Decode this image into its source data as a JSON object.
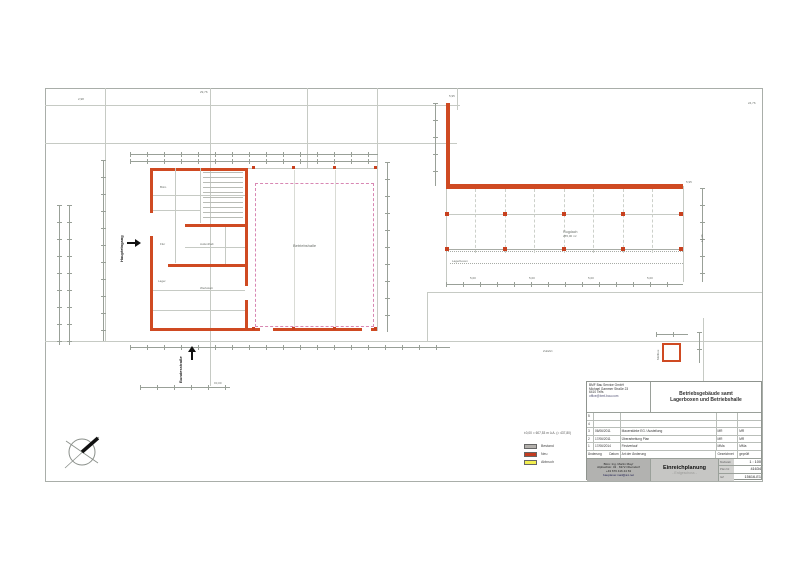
{
  "colors": {
    "wall_new": "#cf4a22",
    "column_red": "#c8401e",
    "roof_dashed": "#d887b3",
    "line_gray": "#b6bab4",
    "legend_bestand": "#b3b0ac",
    "legend_neu": "#c43c20",
    "legend_abbruch": "#f2ee50"
  },
  "plan_labels": {
    "bundesstrasse": "Bundesstraße",
    "haupteingang": "Haupteingang",
    "betriebshalle": "Betriebshalle",
    "flugdach": "Flugdach",
    "flugdach_area": "255,00 m²",
    "lagerboxen": "Lagerboxen",
    "zufahrt": "Zufahrt",
    "muellbox": "Müllbox",
    "room_buero": "Büro",
    "room_flur": "Flur",
    "room_lager": "Lager",
    "room_werkstatt": "Werkstatt",
    "room_aufenthalt": "Aufenthalt"
  },
  "dims": {
    "d_2976": "29,76",
    "d_595a": "5,95",
    "d_595b": "5,95",
    "d_2476": "24,76",
    "d_1246": "12,46",
    "d_500": "5,00",
    "d_298": "2,98",
    "d_pm": "±0,00"
  },
  "legend": {
    "level_note": "±0,00 = 607,53 m ü.A. (= 437,80)",
    "items": [
      {
        "label": "Bestand",
        "color": "#b3b0ac"
      },
      {
        "label": "Neu",
        "color": "#c43c20"
      },
      {
        "label": "Abbruch",
        "color": "#f2ee50"
      }
    ]
  },
  "titleblock": {
    "company_lines": [
      "BMF Bau Service GmbH",
      "Michael Gammer Straße 23",
      "6410 Telfs",
      "office@bmf-bau.com"
    ],
    "project_title_line1": "Betriebsgebäude samt",
    "project_title_line2": "Lagerboxen und Betriebshalle",
    "revisions": {
      "rows": [
        {
          "nr": "5",
          "datum": "",
          "text": "",
          "gez": "",
          "gepr": ""
        },
        {
          "nr": "4",
          "datum": "",
          "text": "",
          "gez": "",
          "gepr": ""
        },
        {
          "nr": "3",
          "datum": "06/06/2011",
          "text": "Mauerstärke EG / Austeilung",
          "gez": "MR",
          "gepr": "MR"
        },
        {
          "nr": "2",
          "datum": "17/06/2011",
          "text": "Überarbeitung Plan",
          "gez": "MR",
          "gepr": "MR"
        },
        {
          "nr": "1",
          "datum": "17/06/2014",
          "text": "Firstverlauf",
          "gez": "MMa",
          "gepr": "MMa"
        }
      ],
      "header": {
        "aenderung": "Änderung",
        "datum": "Datum",
        "art": "Art der Änderung",
        "gez": "Gezeichnet",
        "gepr": "geprüft"
      }
    },
    "architect_lines": [
      "Büro: Ing. Martin Mayr",
      "Alpbachstr. 43 · 6372 Oberndorf",
      "+43 676 416 44 63",
      "bauplaner.mail@a1.net"
    ],
    "plan_type": "Einreichplanung",
    "plan_subtitle": "- Erdgeschoss -",
    "meta": [
      {
        "label": "Maßstab",
        "value": "1 : 100"
      },
      {
        "label": "Plan Nr.",
        "value": "41634"
      },
      {
        "label": "GZ",
        "value": "15616-E1"
      }
    ]
  }
}
